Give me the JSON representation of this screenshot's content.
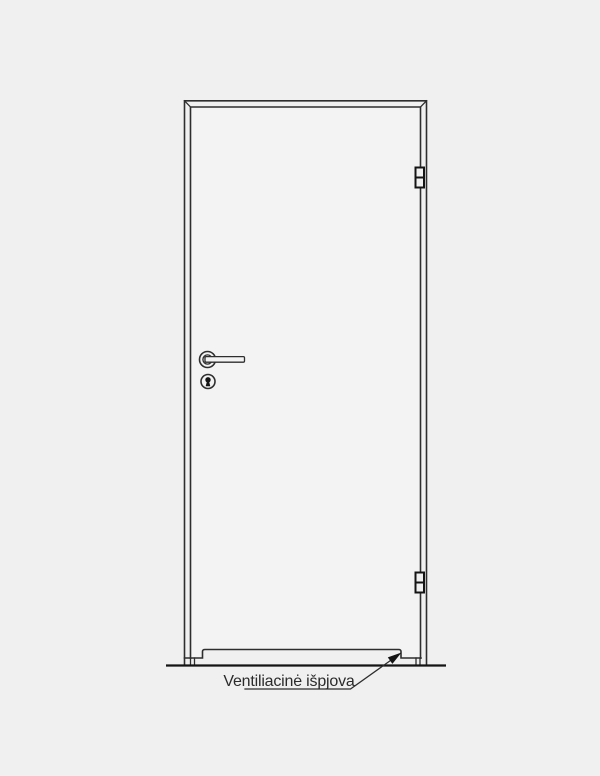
{
  "drawing": {
    "type": "door-elevation-technical-drawing",
    "annotation": {
      "label": "Ventiliacinė išpjova"
    },
    "parts": {
      "frame": "door frame with mitered top corners",
      "leaf": "door leaf",
      "hinge_count": 2,
      "handle": "lever handle with round rosette",
      "keyhole": "cylinder keyhole escutcheon",
      "cutout": "ventilation cutout along bottom edge",
      "floor": "floor line"
    },
    "colors": {
      "background": "#f0f0f0",
      "line": "#2e2e2e",
      "line_strong": "#141414",
      "panel": "#f3f3f3",
      "text": "#2b2b2b"
    }
  }
}
